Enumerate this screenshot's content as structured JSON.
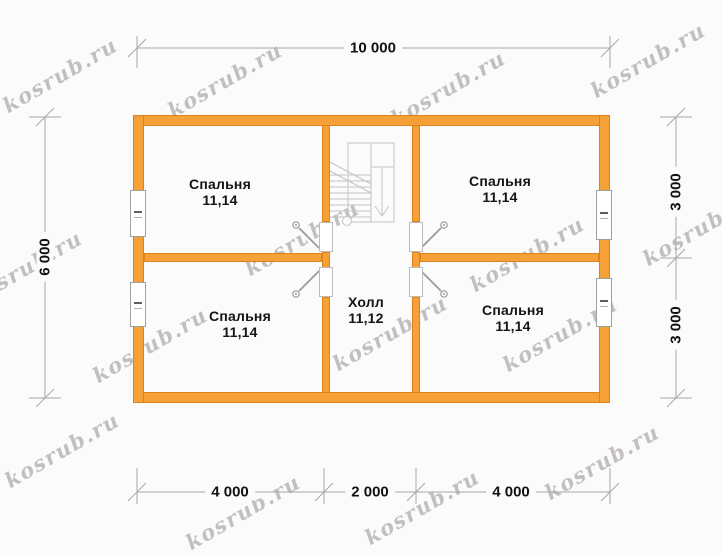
{
  "watermark": {
    "text": "kosrub.ru",
    "color": "#968e92"
  },
  "colors": {
    "wall_fill": "#f6a137",
    "wall_stroke": "#e0821c",
    "background": "#fbfbfb",
    "dimension_line": "#a4aaa7",
    "stair_line": "#c2c6c6",
    "door_line": "#9a9a9a",
    "label_text": "#141414"
  },
  "rooms": {
    "bedroom_top_left": {
      "name": "Спальня",
      "area": "11,14"
    },
    "bedroom_top_right": {
      "name": "Спальня",
      "area": "11,14"
    },
    "bedroom_bottom_left": {
      "name": "Спальня",
      "area": "11,14"
    },
    "bedroom_bottom_right": {
      "name": "Спальня",
      "area": "11,14"
    },
    "hall": {
      "name": "Холл",
      "area": "11,12"
    }
  },
  "dimensions": {
    "top_total": "10 000",
    "left_total": "6 000",
    "right_top": "3 000",
    "right_bottom": "3 000",
    "bottom_left": "4 000",
    "bottom_center": "2 000",
    "bottom_right": "4 000"
  }
}
